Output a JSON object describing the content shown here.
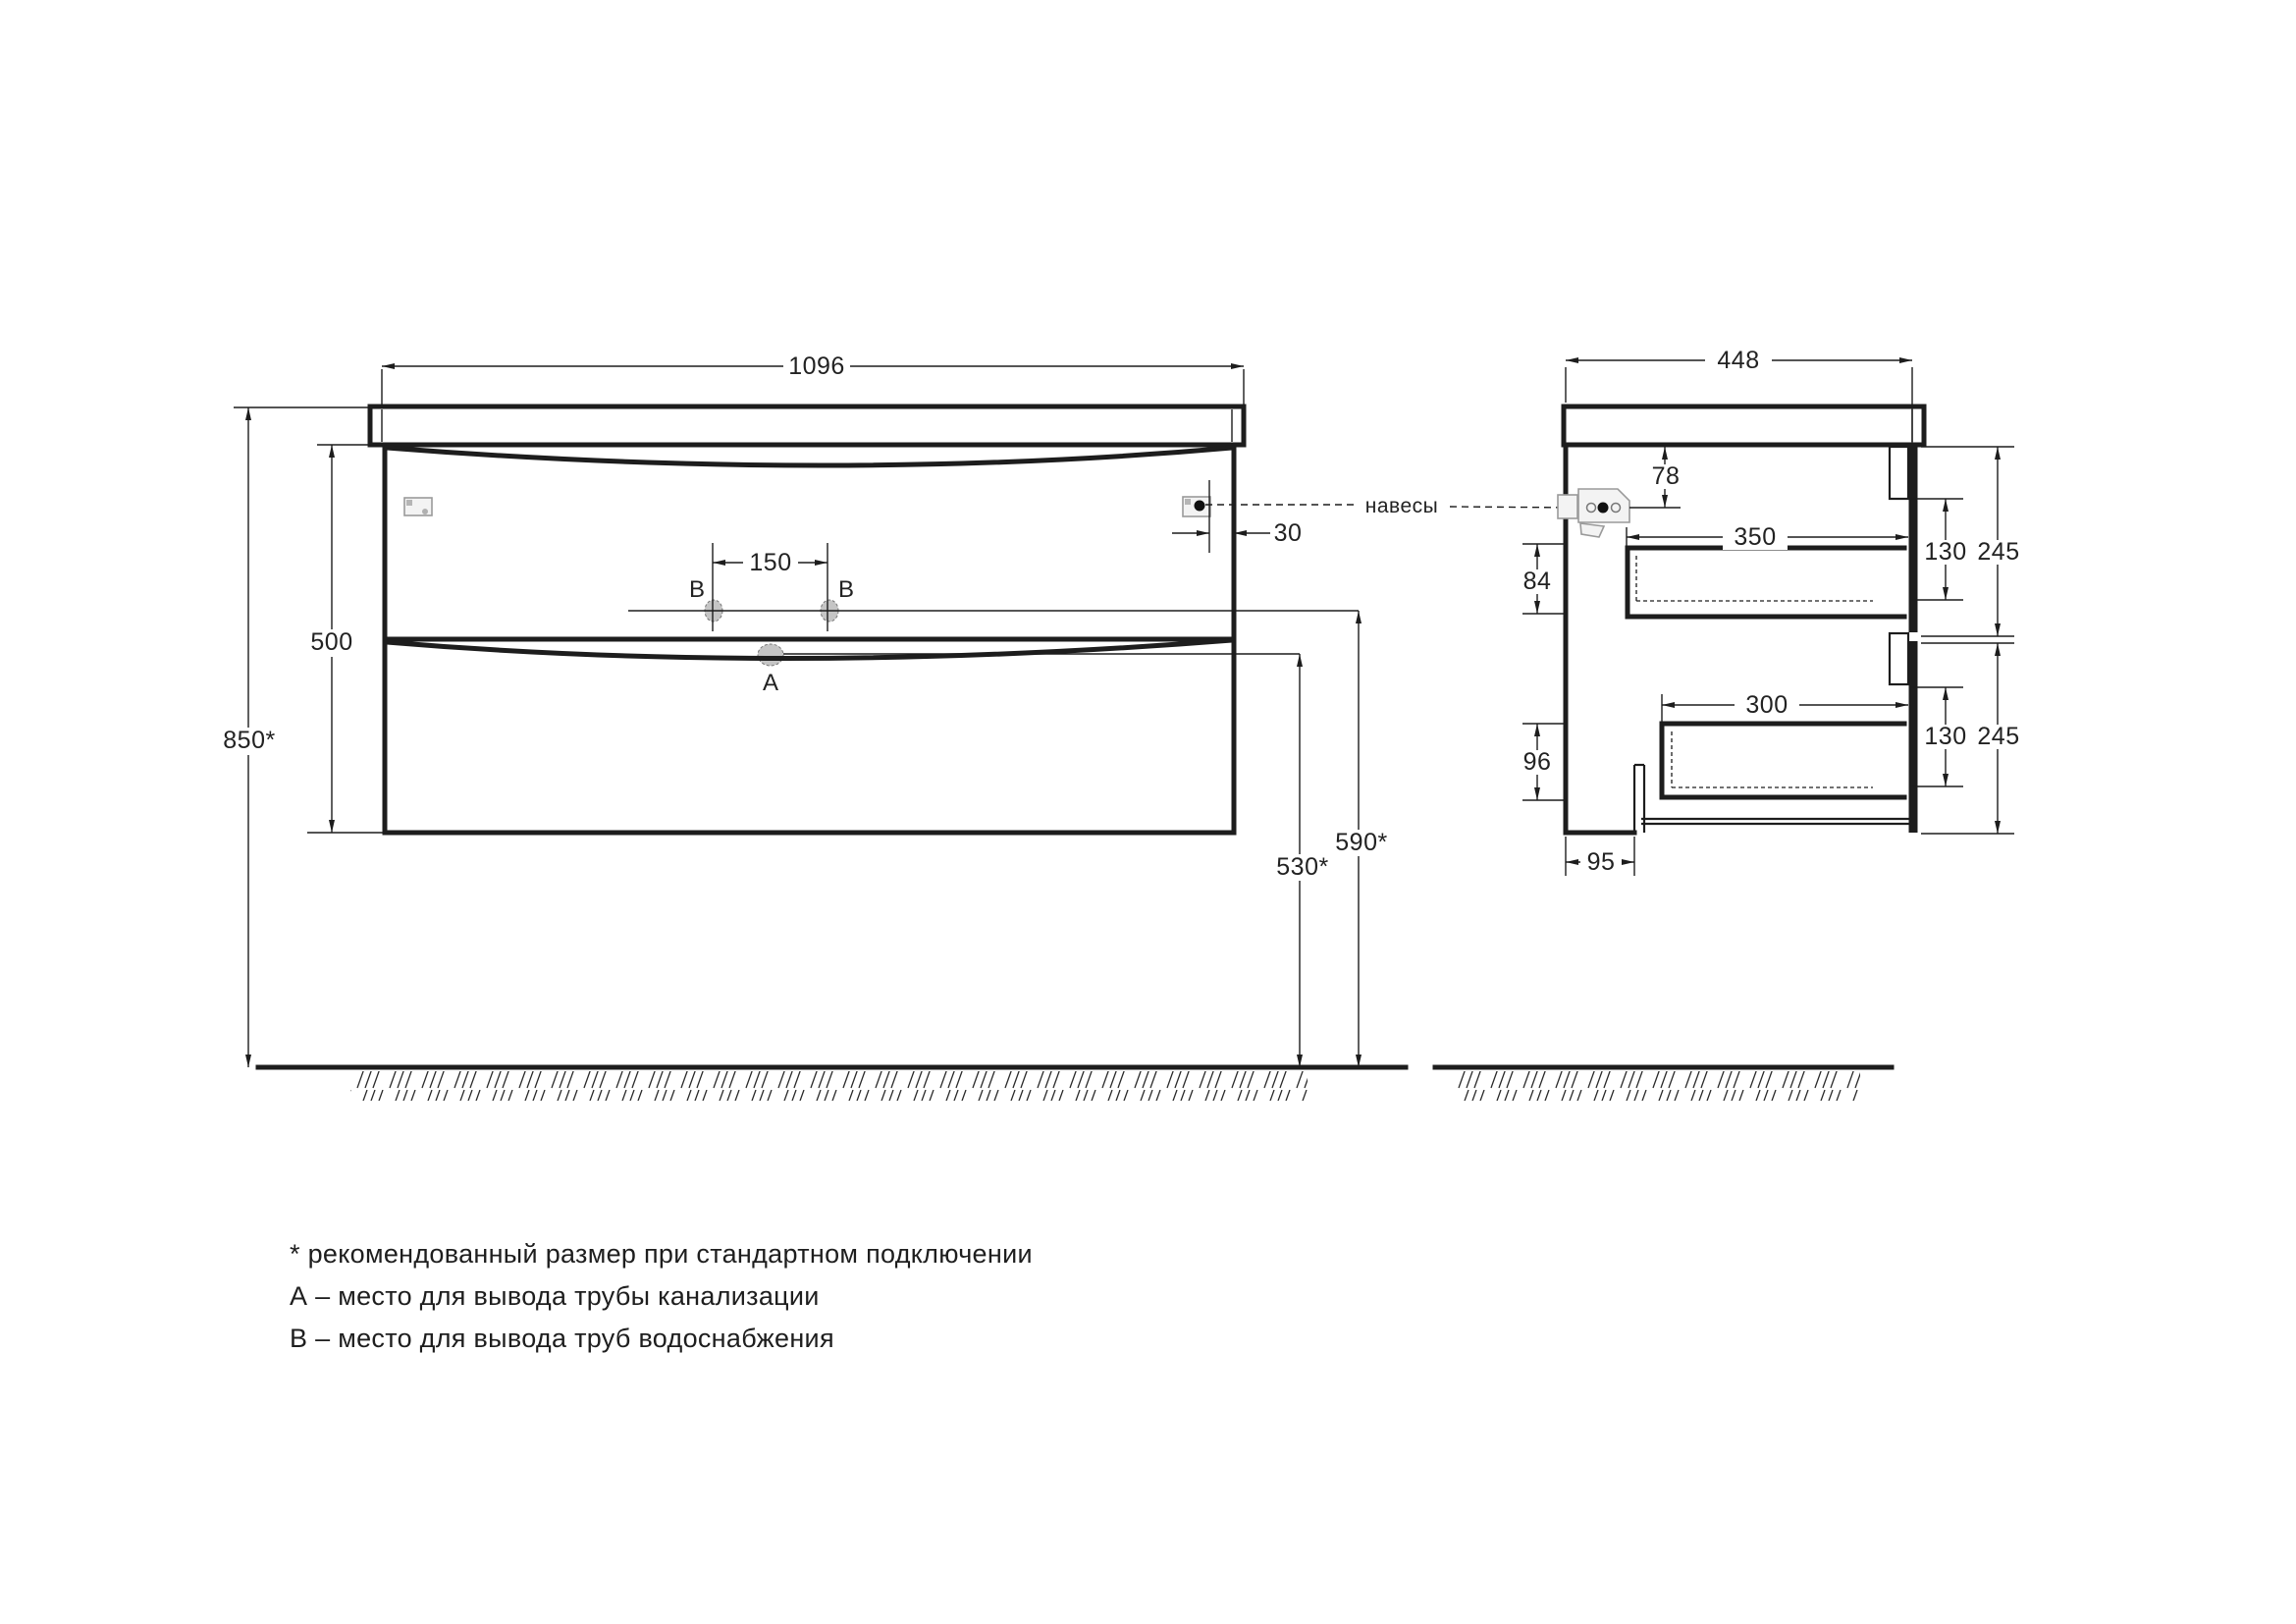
{
  "colors": {
    "line": "#1d1d1d",
    "hole_fill": "#c5c5c5",
    "hole_stroke": "#777777"
  },
  "front_view": {
    "overall_width": "1096",
    "overall_height": "850*",
    "cabinet_height": "500",
    "supply_spacing": "150",
    "bracket_offset": "30",
    "supply_height": "590*",
    "drain_height": "530*",
    "drain_point": "A",
    "supply_point_left": "B",
    "supply_point_right": "B"
  },
  "side_view": {
    "overall_depth": "448",
    "bracket_drop": "78",
    "upper_drawer_depth": "350",
    "upper_drawer_side_height": "84",
    "upper_drawer_box_height": "130",
    "upper_front_height": "245",
    "lower_drawer_depth": "300",
    "lower_drawer_side_height": "96",
    "lower_drawer_box_height": "130",
    "lower_front_height": "245",
    "drain_cutout_offset": "95"
  },
  "callout": {
    "hangers_label": "навесы"
  },
  "legend": {
    "note_asterisk": "* рекомендованный размер при стандартном подключении",
    "note_a": "А – место для вывода трубы канализации",
    "note_b": "В – место для вывода труб водоснабжения"
  }
}
